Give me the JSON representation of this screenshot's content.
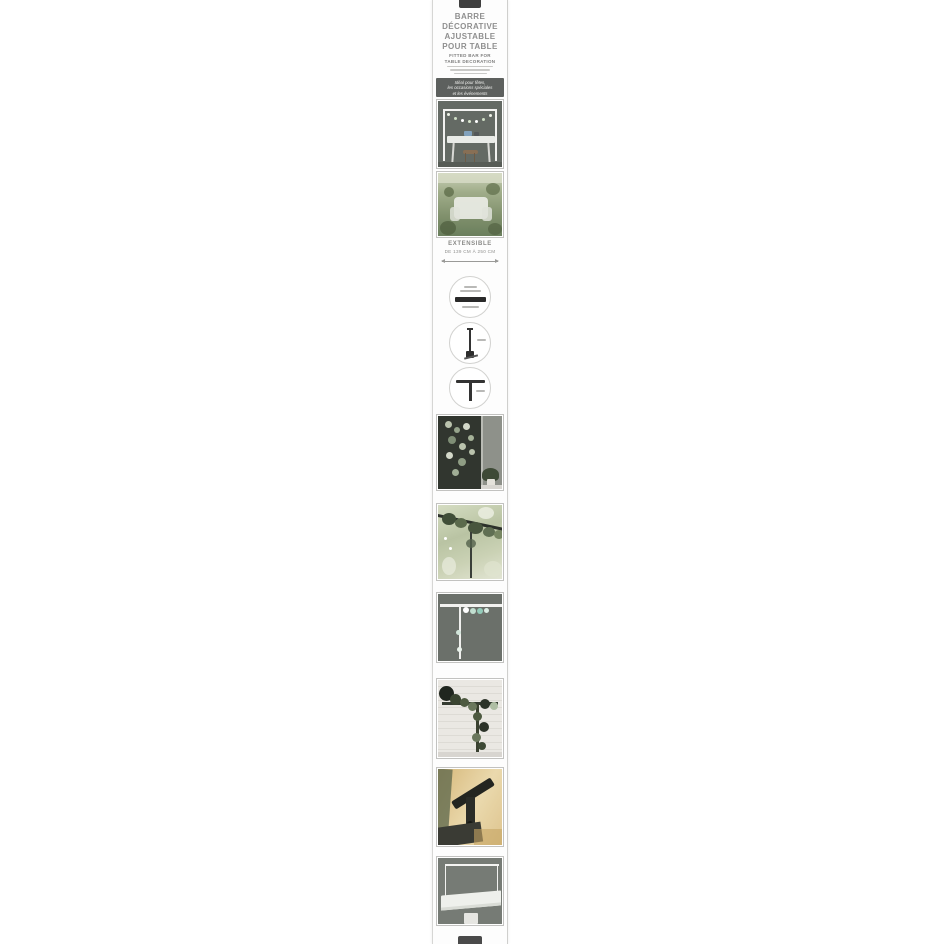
{
  "package": {
    "title_lines": [
      "BARRE",
      "DÉCORATIVE",
      "AJUSTABLE",
      "POUR TABLE"
    ],
    "subtitle_lines": [
      "FITTED BAR FOR",
      "TABLE DECORATION"
    ],
    "tagline_lines": [
      "Idéal pour fêtes,",
      "les occasions spéciales",
      "et les événements"
    ],
    "extensible": {
      "label": "EXTENSIBLE",
      "range": "DE 139 CM À 250 CM"
    },
    "colors": {
      "band_background": "#5d605e",
      "title_text": "#8f8f8f",
      "bar_dark": "#2a2a2a",
      "package_background": "#fdfdfd"
    }
  }
}
